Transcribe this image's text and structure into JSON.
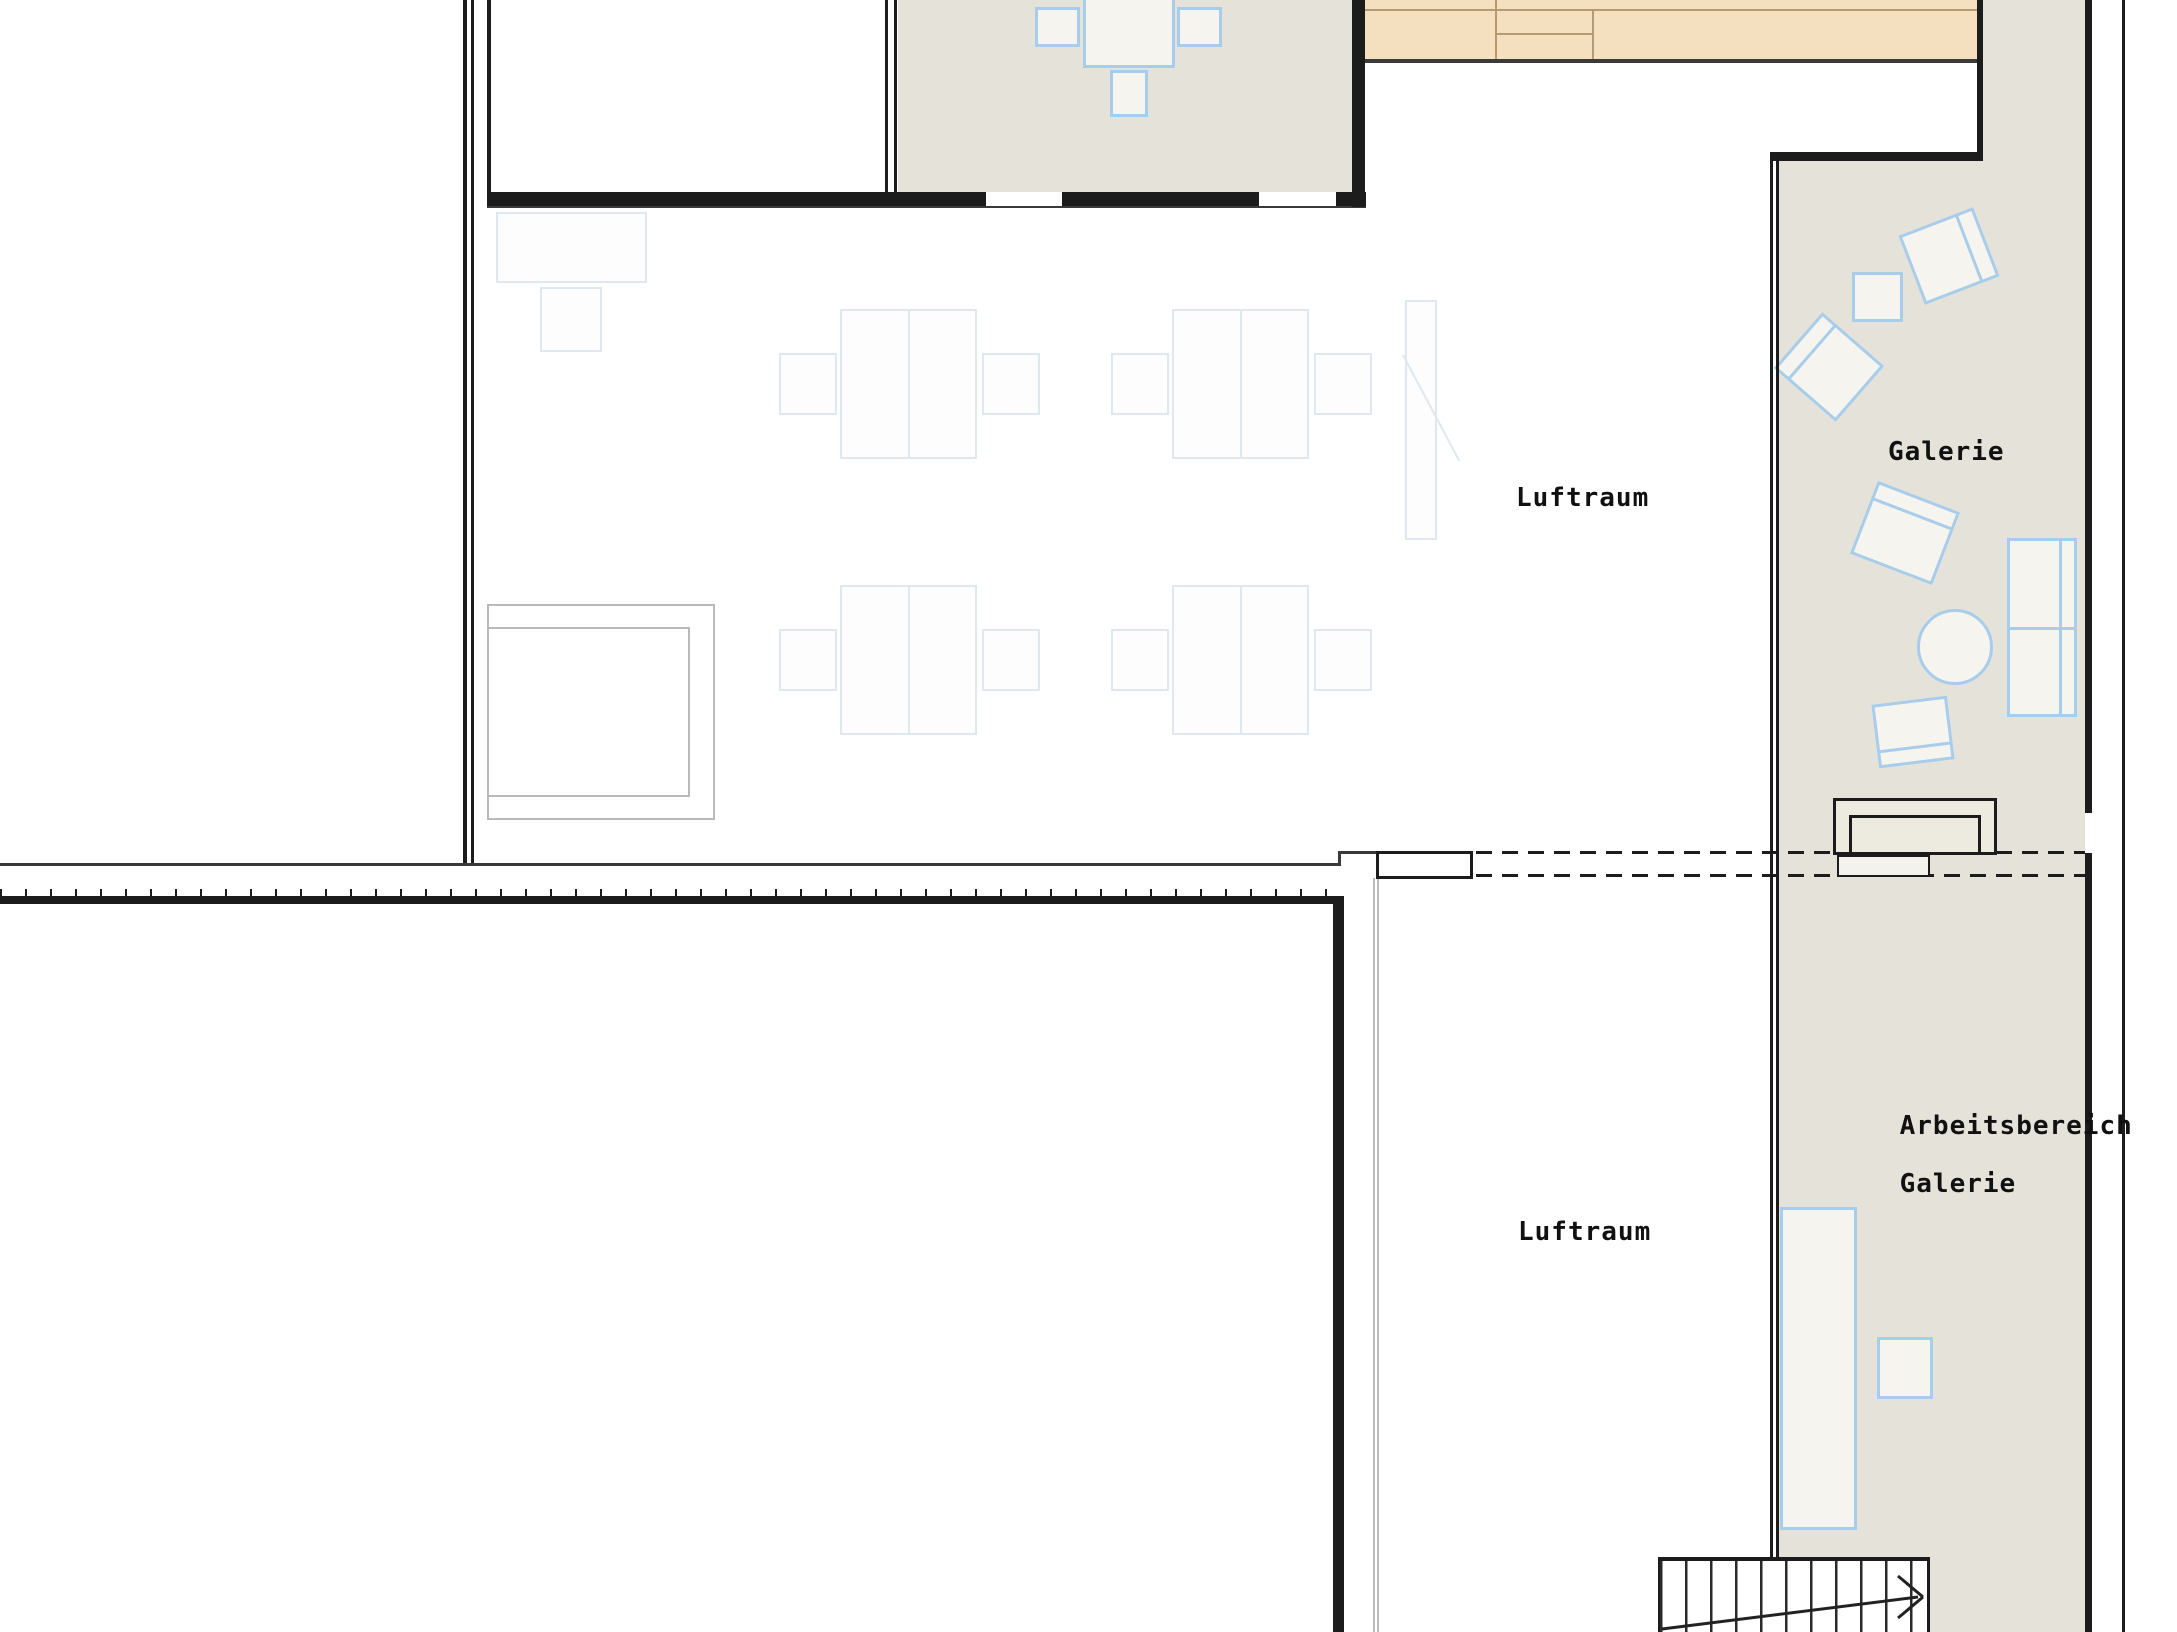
{
  "labels": {
    "galerie": "Galerie",
    "luftraum_upper": "Luftraum",
    "luftraum_lower": "Luftraum",
    "arbeitsbereich_line1": "Arbeitsbereich",
    "arbeitsbereich_line2": "Galerie"
  },
  "colors": {
    "wall": "#1c1c1c",
    "beige": "#e5e2d9",
    "wood": "#f4e0be",
    "wood_line": "#b59a74",
    "grey": "#b9b9b9",
    "blue_border": "#a8cdeb",
    "blue_fill": "#f6f4ef",
    "faint_border": "#dfe8f0",
    "faint_fill": "#fdfdfe",
    "text": "#111111"
  }
}
